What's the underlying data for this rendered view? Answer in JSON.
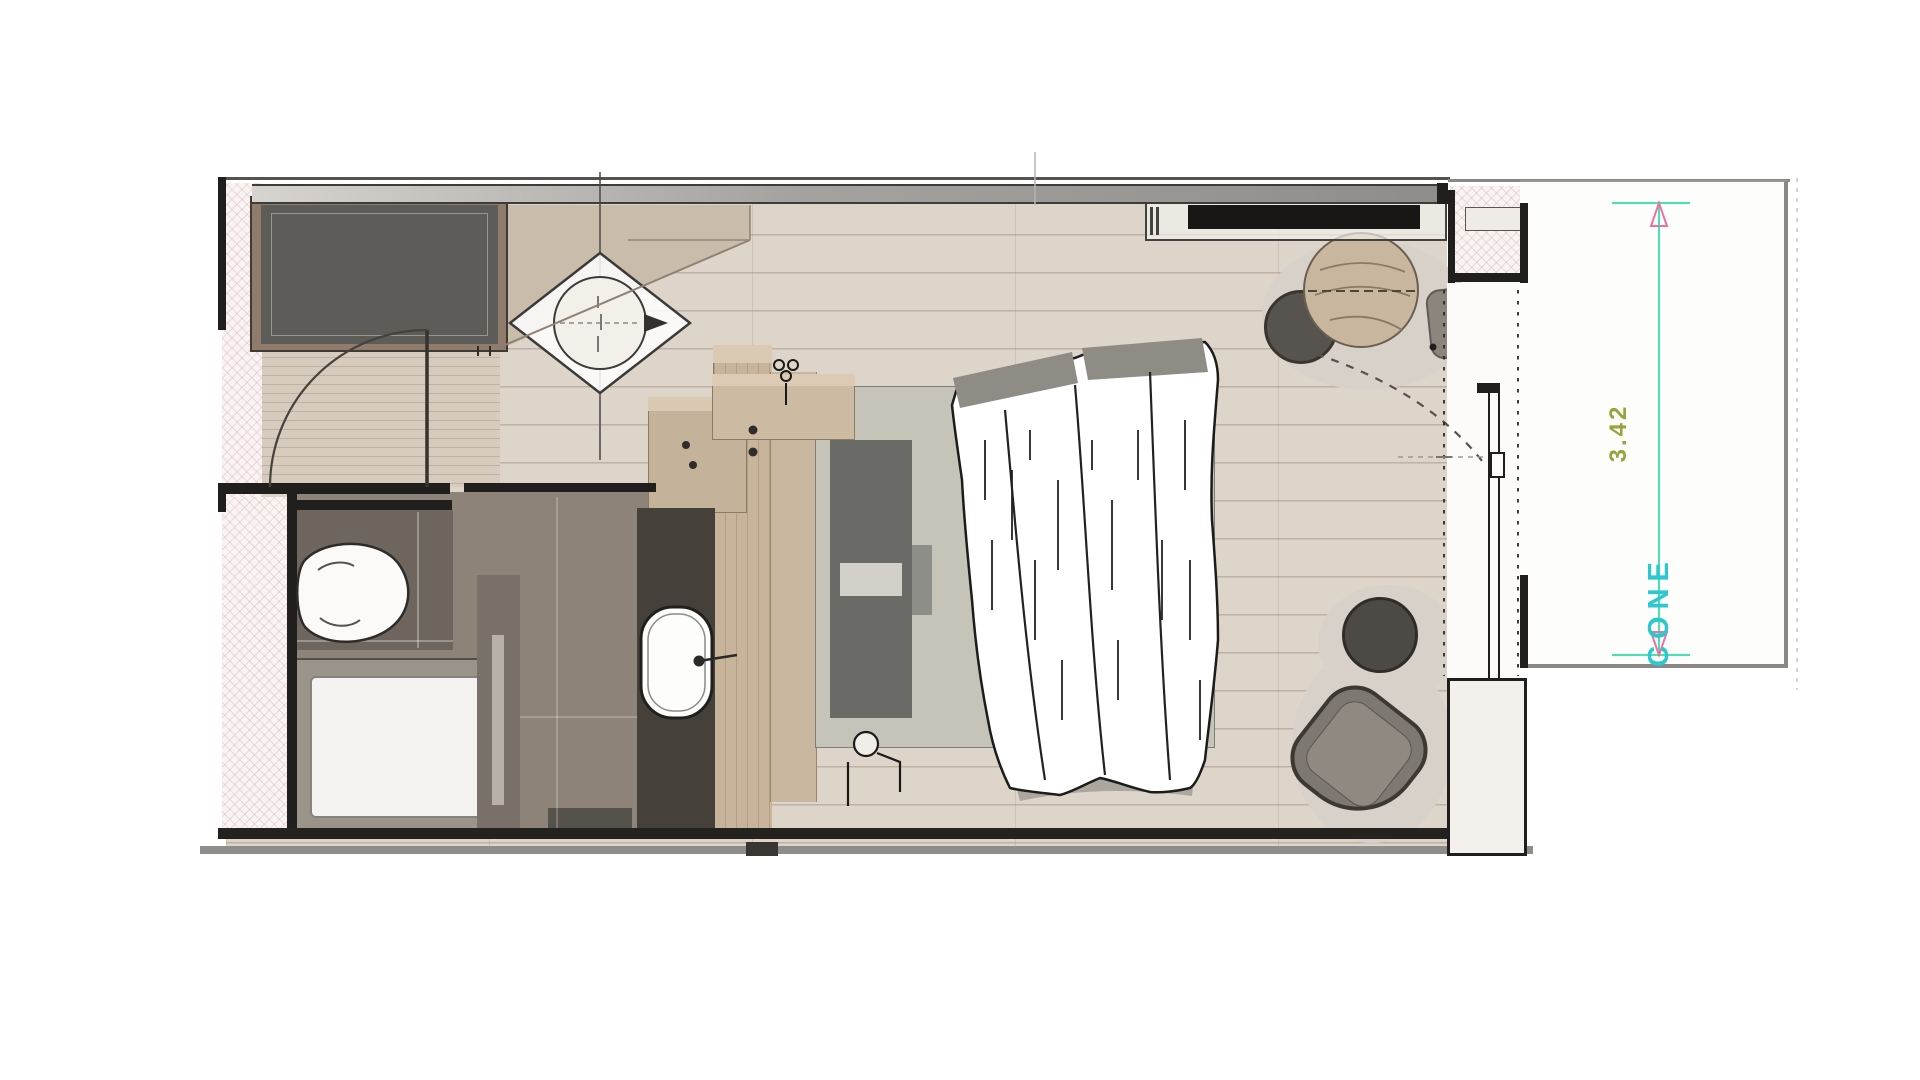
{
  "annotations": {
    "balcony_depth": "3.42",
    "balcony_label": "CONE"
  },
  "colors": {
    "floor": "#ddd5c9",
    "floor_line": "#c7beb1",
    "exterior_hatch": "#f9f3f1",
    "wall_dark": "#201f1d",
    "wall_gray": "#8f8d8a",
    "wardrobe": "#5d5c58",
    "wood": "#c7b49b",
    "bath_floor": "#8d8378",
    "bath_dark_tile": "#6e665e",
    "vanity": "#45403a",
    "bed_sheet": "#c6c3b9",
    "pillow": "#6a6a66",
    "duvet": "#ffffff",
    "chair_dark": "#57534e",
    "armchair": "#7e7872",
    "stool": "#4d4a46",
    "shadow": "#d7d1c9",
    "dimension_line": "#45e2b4",
    "dimension_arrow": "#ef6fa0",
    "dimension_text": "#9aa23c",
    "area_text": "#2cc8cd"
  },
  "furniture": [
    "wardrobe",
    "entry-door",
    "section-marker",
    "toilet",
    "shower",
    "sink-vanity",
    "minibar",
    "nightstand",
    "wall-lamp",
    "double-bed",
    "duvet",
    "tv-console",
    "dining-table",
    "dining-chair",
    "side-stool",
    "armchair",
    "balcony-door",
    "balcony"
  ]
}
